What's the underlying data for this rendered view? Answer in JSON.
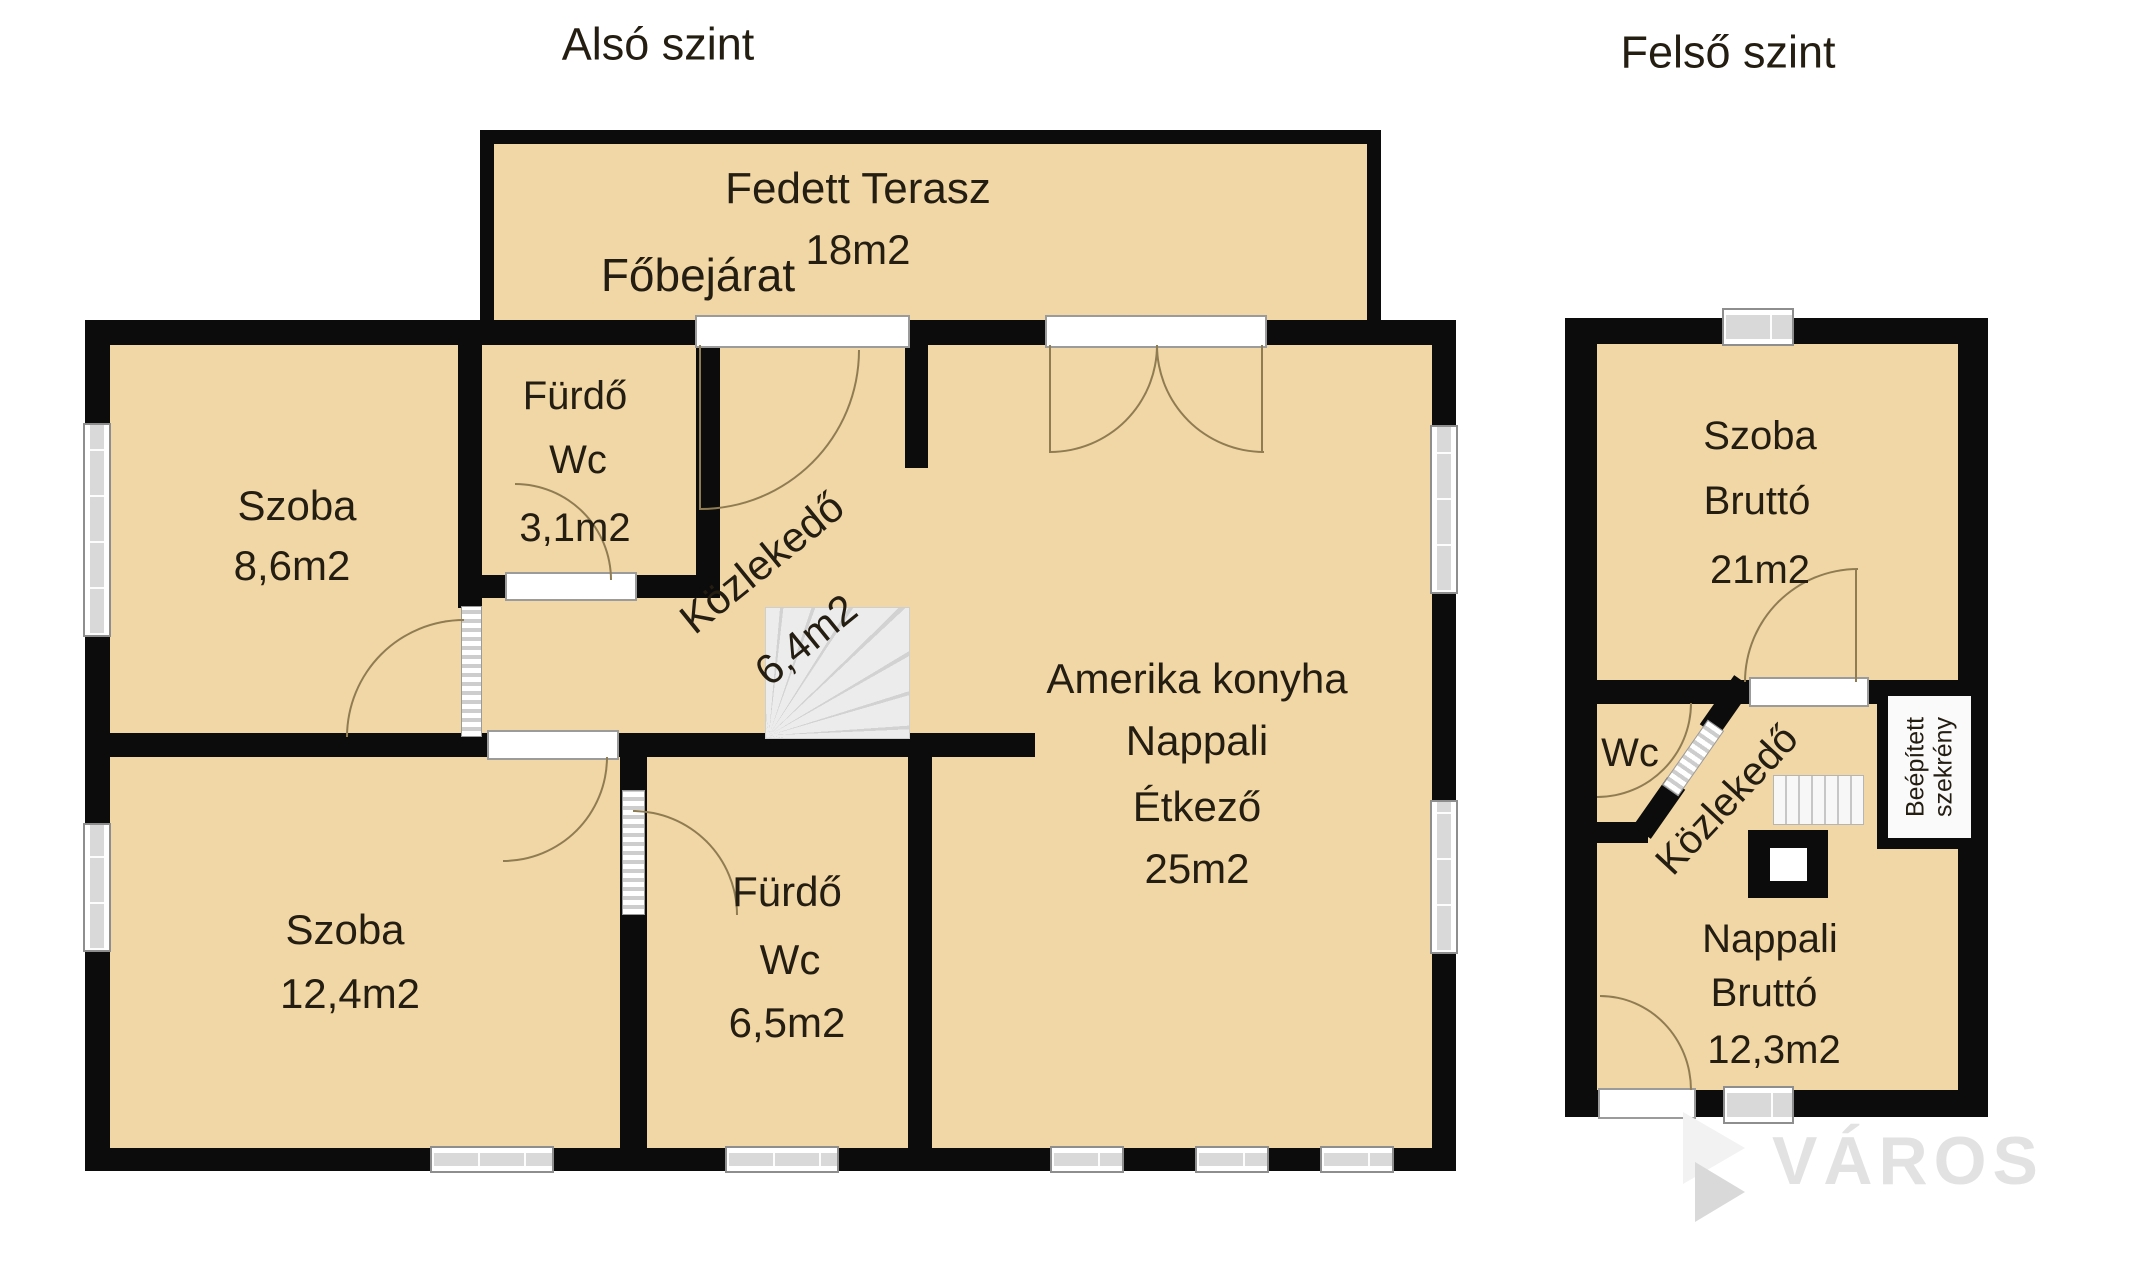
{
  "titles": {
    "lower": "Alsó szint",
    "upper": "Felső szint"
  },
  "lower": {
    "terrace_name": "Fedett Terasz",
    "terrace_area": "18m2",
    "entrance": "Főbejárat",
    "szoba1": [
      "Szoba",
      "8,6m2"
    ],
    "furdo1": [
      "Fürdő",
      "Wc",
      "3,1m2"
    ],
    "kozlekedo": [
      "Közlekedő",
      "6,4m2"
    ],
    "amerika": [
      "Amerika konyha",
      "Nappali",
      "Étkező",
      "25m2"
    ],
    "szoba2": [
      "Szoba",
      "12,4m2"
    ],
    "furdo2": [
      "Fürdő",
      "Wc",
      "6,5m2"
    ]
  },
  "upper": {
    "szoba": [
      "Szoba",
      "Bruttó",
      "21m2"
    ],
    "wc": "Wc",
    "kozlekedo": "Közlekedő",
    "szekreny": [
      "Beépített",
      "szekrény"
    ],
    "nappali": [
      "Nappali",
      "Bruttó",
      "12,3m2"
    ]
  },
  "watermark": {
    "text": "VÁROS"
  },
  "colors": {
    "floor": "#f2d7a6",
    "wall": "#0c0c0c",
    "door_arc": "#8f7c52",
    "window_fill": "#d9d9d9",
    "watermark": "#e2e2e2"
  }
}
